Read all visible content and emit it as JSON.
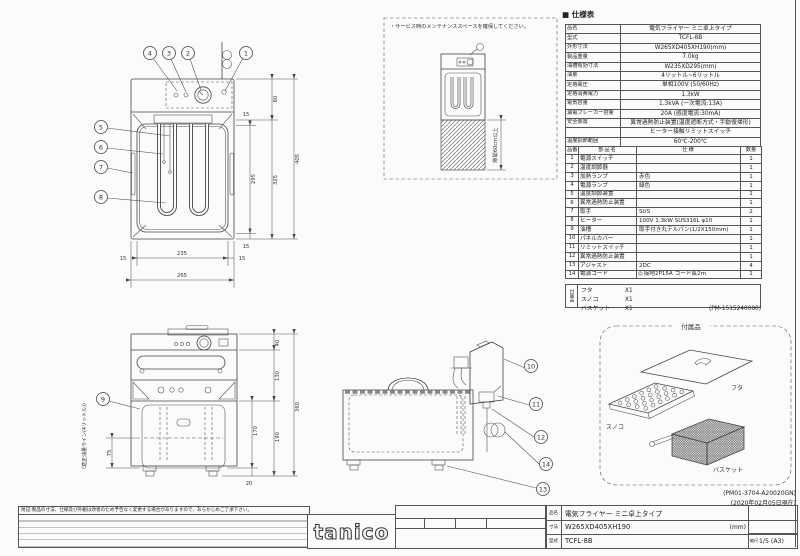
{
  "spec": {
    "title": "■ 仕様表",
    "rows": [
      {
        "label": "品名",
        "value": "電気フライヤー ミニ卓上タイプ"
      },
      {
        "label": "型式",
        "value": "TCFL-8B"
      },
      {
        "label": "外形寸法",
        "value": "W265XD405XH190(mm)"
      },
      {
        "label": "製品重量",
        "value": "7.0kg"
      },
      {
        "label": "油槽有効寸法",
        "value": "W235XD295(mm)"
      },
      {
        "label": "油量",
        "value": "4リットル~6リットル"
      },
      {
        "label": "定格電圧",
        "value": "単相100V (50/60Hz)"
      },
      {
        "label": "定格消費電力",
        "value": "1.3kW"
      },
      {
        "label": "電気容量",
        "value": "1.3kVA (一次電流:13A)"
      },
      {
        "label": "漏電ブレーカー容量",
        "value": "20A (感度電流:30mA)"
      },
      {
        "label": "安全装置",
        "value": "異常過熱防止装置(温度遮断方式・手動復帰形)"
      },
      {
        "label": "",
        "value": "ヒーター接触リミットスイッチ"
      },
      {
        "label": "温度調節範囲",
        "value": "60℃-200℃"
      }
    ]
  },
  "parts": {
    "headers": [
      "品番",
      "部品名",
      "仕様",
      "数量"
    ],
    "rows": [
      {
        "num": "1",
        "name": "電源スイッチ",
        "spec": "",
        "qty": "1"
      },
      {
        "num": "2",
        "name": "温度調節器",
        "spec": "",
        "qty": "1"
      },
      {
        "num": "3",
        "name": "加熱ランプ",
        "spec": "赤色",
        "qty": "1"
      },
      {
        "num": "4",
        "name": "電源ランプ",
        "spec": "緑色",
        "qty": "1"
      },
      {
        "num": "5",
        "name": "温度調節装置",
        "spec": "",
        "qty": "1"
      },
      {
        "num": "6",
        "name": "異常過熱防止装置",
        "spec": "",
        "qty": "1"
      },
      {
        "num": "7",
        "name": "取手",
        "spec": "SUS",
        "qty": "2"
      },
      {
        "num": "8",
        "name": "ヒーター",
        "spec": "100V 1.3kW SUS316L φ10",
        "qty": "1"
      },
      {
        "num": "9",
        "name": "油槽",
        "spec": "取手付き丸テルパン(1/2X150mm)",
        "qty": "1"
      },
      {
        "num": "10",
        "name": "パネルカバー",
        "spec": "",
        "qty": "1"
      },
      {
        "num": "11",
        "name": "リミットスイッチ",
        "spec": "",
        "qty": "1"
      },
      {
        "num": "12",
        "name": "異常過熱防止装置",
        "spec": "",
        "qty": "1"
      },
      {
        "num": "13",
        "name": "アジャスト",
        "spec": "2DC",
        "qty": "4"
      },
      {
        "num": "14",
        "name": "電源コード",
        "icon": "◎",
        "spec": "接地2P15A コード長2m",
        "qty": "1"
      }
    ]
  },
  "accessories_list": {
    "label": "付属品",
    "items": [
      {
        "name": "フタ",
        "qty": "X1"
      },
      {
        "name": "スノコ",
        "qty": "X1"
      },
      {
        "name": "バスケット",
        "qty": "X1"
      }
    ]
  },
  "docs": {
    "pm1": "(PM-1515240000)",
    "pm2": "(PM01-3704-A20020GN)",
    "date": "(2020年02月05日現在)"
  },
  "title_block": {
    "note": "附記:製品の寸法、仕様及び外観は改善のため予告なく変更する場合がありますので、あらかじめご了承下さい。",
    "logo": "tanico",
    "product_label": "品名",
    "product": "電気フライヤー ミニ卓上タイプ",
    "size_label": "寸法",
    "size": "W265XD405XH190",
    "size_unit": "(mm)",
    "model_label": "型式",
    "model": "TCFL-8B",
    "scale_label": "縮尺",
    "scale": "1/5 (A3)"
  },
  "drawings": {
    "plan": {
      "callouts": [
        "4",
        "3",
        "2",
        "1",
        "5",
        "6",
        "7",
        "8"
      ],
      "dims_right": [
        "15",
        "295",
        "15",
        "80",
        "325",
        "405"
      ],
      "dims_bottom": [
        "15",
        "235",
        "15",
        "265"
      ]
    },
    "clearance": {
      "note": "・サービス時のメンテナンススペースを確保してください。",
      "gap": "隙間60cm以上"
    },
    "front": {
      "callout": "9",
      "oil_label": "〈適正油量ライン(4リットル)〉",
      "dims": [
        "40",
        "130",
        "170",
        "190",
        "20",
        "360",
        "75"
      ]
    },
    "side": {
      "callouts": [
        "10",
        "11",
        "12",
        "14",
        "13"
      ]
    },
    "acc_box": {
      "title": "付属品",
      "items": [
        "フタ",
        "スノコ",
        "バスケット"
      ]
    }
  }
}
